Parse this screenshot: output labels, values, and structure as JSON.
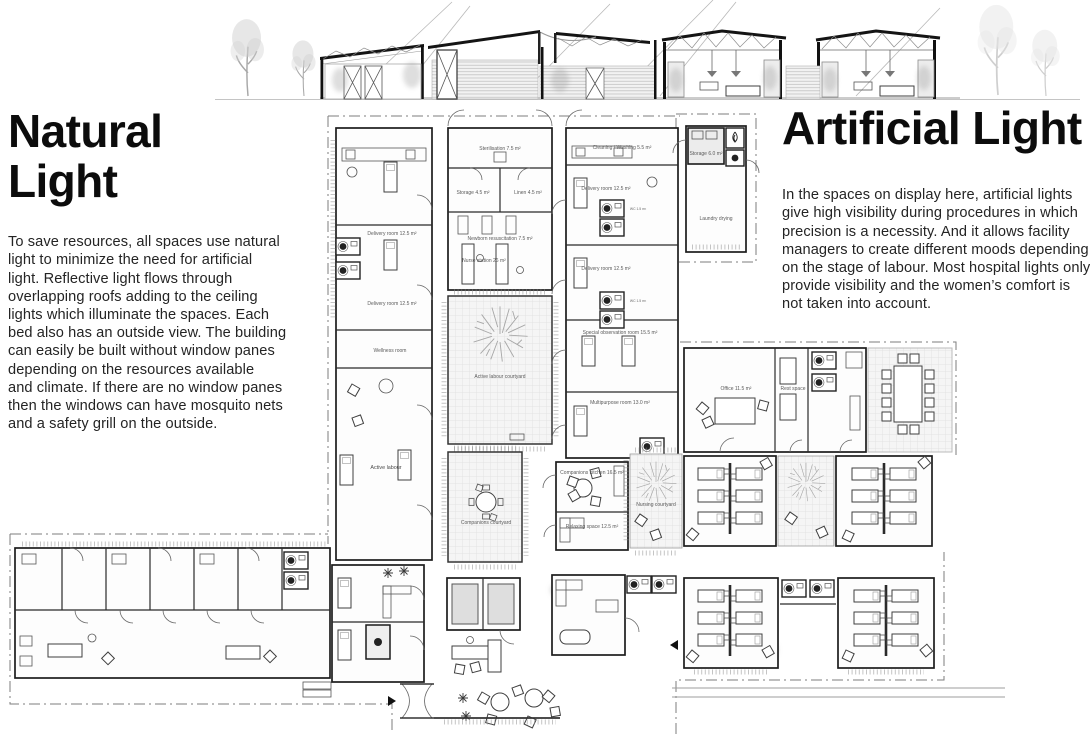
{
  "colors": {
    "paper": "#ffffff",
    "ink": "#0c0c0c",
    "body_text": "#242424",
    "plan_line": "#1c1c1c",
    "plan_label": "#5a5a5a"
  },
  "left_panel": {
    "title_lines": [
      "Natural",
      "Light"
    ],
    "body_lines": [
      "To save resources, all spaces use natural",
      "light to minimize the need for artificial",
      "light. Reflective light flows through",
      "overlapping roofs adding to the ceiling",
      "lights which illuminate the spaces. Each",
      "bed also has an outside view. The building",
      "can easily be built without window panes",
      "depending on the resources available",
      "and climate. If there are no window panes",
      "then the windows can have mosquito nets",
      "and a safety grill on the outside."
    ]
  },
  "right_panel": {
    "title": "Artificial Light",
    "body_lines": [
      "In the spaces on display here, artificial lights",
      "give high visibility during procedures in which",
      "precision is a necessity. And it allows facility",
      "managers to create different moods depending",
      "on the stage of labour. Most hospital lights only",
      "provide visibility and the women’s comfort is",
      "not taken into account."
    ]
  },
  "plan": {
    "rooms": {
      "sterilisation": "Sterilisation 7.5 m²",
      "storage": "Storage 4.5 m²",
      "linen": "Linen 4.5 m²",
      "newborn_resuscitation": "Newborn resuscitation 7.5 m²",
      "nurse_station": "Nurse station 26 m²",
      "cleaning_washing": "Cleaning / Washing 5.5 m²",
      "delivery_room_1": "Delivery room 12.5 m²",
      "delivery_room_2": "Delivery room 12.5 m²",
      "delivery_room_3": "Delivery room 12.5 m²",
      "delivery_room_4": "Delivery room 12.5 m²",
      "wellness_room": "Wellness room",
      "special_observation": "Special observation room 15.5 m²",
      "multipurpose": "Multipurpose room 13.0 m²",
      "active_labour": "Active labour",
      "active_labour_courtyard": "Active labour courtyard",
      "companions_courtyard": "Companions courtyard",
      "companions_kitchen": "Companions kitchen 16.5 m²",
      "relaxing_space": "Relaxing space 12.5 m²",
      "nursing_courtyard": "Nursing courtyard",
      "office": "Office 11.5 m²",
      "rest_space": "Rest space",
      "laundry_storage": "Storage 6.0 m²",
      "laundry_drying": "Laundry drying",
      "wc_1": "WC 1.5 m²",
      "wc_2": "WC 1.5 m²"
    }
  }
}
